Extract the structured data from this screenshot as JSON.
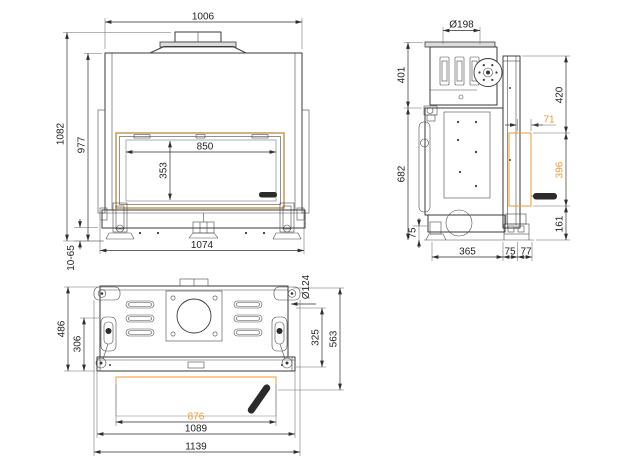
{
  "drawing": {
    "colors": {
      "line": "#3a3a3a",
      "accent": "#ED9B33",
      "frame_accent": "#C9A063"
    },
    "front_view": {
      "dims": {
        "top_width": "1006",
        "overall_height": "1082",
        "body_height": "977",
        "glass_width": "850",
        "glass_height": "353",
        "base_width": "1074",
        "foot_adjust": "10-65"
      }
    },
    "side_view": {
      "dims": {
        "flue_diameter": "Ø198",
        "collar_height": "401",
        "body_height": "682",
        "base_height": "75",
        "front_top": "420",
        "offset": "71",
        "glass_zone": "396",
        "front_bottom": "161",
        "depth": "365",
        "depth_front": "75",
        "depth_edge": "77"
      }
    },
    "plan_view": {
      "dims": {
        "port_diameter": "Ø124",
        "depth_left": "486",
        "depth_inner": "306",
        "depth_right": "563",
        "depth_mid": "325",
        "glass_width": "876",
        "frame_width": "1089",
        "overall_width": "1139"
      }
    }
  }
}
